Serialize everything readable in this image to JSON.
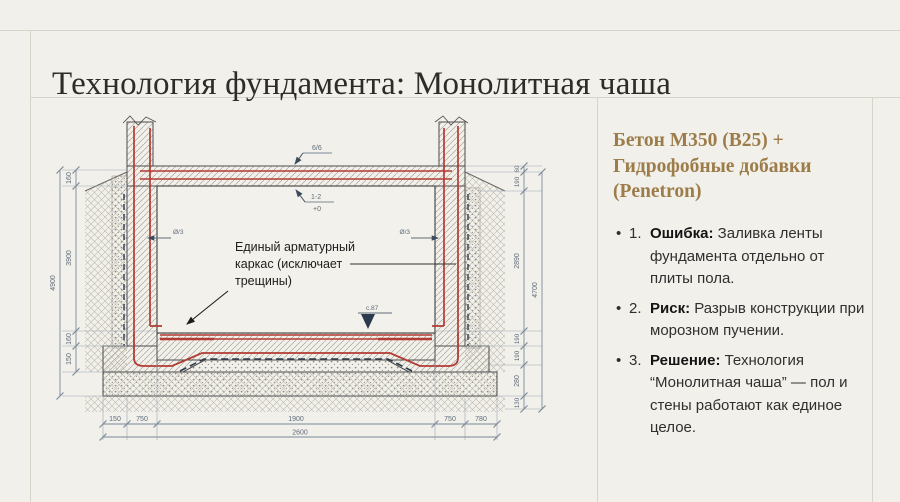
{
  "slide": {
    "title": "Технология фундамента: Монолитная чаша"
  },
  "right_panel": {
    "heading": "Бетон М350 (В25) + Гидрофобные добавки (Penetron)",
    "bullets": [
      {
        "num": "1.",
        "term": "Ошибка:",
        "text": " Заливка ленты фундамента отдельно от плиты пола."
      },
      {
        "num": "2.",
        "term": "Риск:",
        "text": " Разрыв конструкции при морозном пучении."
      },
      {
        "num": "3.",
        "term": "Решение:",
        "text": " Технология “Монолитная чаша” — пол и стены работают как единое целое."
      }
    ]
  },
  "drawing": {
    "note_lines": [
      "Единый арматурный",
      "каркас (исключает",
      "трещины)"
    ],
    "marks": {
      "top": "6/6",
      "mid": "1-2",
      "mid_value": "+0",
      "left_rebar": "Ø/3",
      "right_rebar": "Ø/3",
      "floor": "с.87"
    },
    "dims": {
      "left_chain": [
        "160",
        "3900",
        "160",
        "150"
      ],
      "left_overall": "4900",
      "right_chain": [
        "60",
        "190",
        "2890",
        "190",
        "190",
        "280",
        "130"
      ],
      "right_overall": "4700",
      "bottom_chain": [
        "150",
        "750",
        "1900",
        "750",
        "780"
      ],
      "bottom_overall": "2600"
    },
    "colors": {
      "rebar": "#b23b33",
      "dimension": "#7b8a99",
      "membrane": "#2c3a4d"
    }
  }
}
